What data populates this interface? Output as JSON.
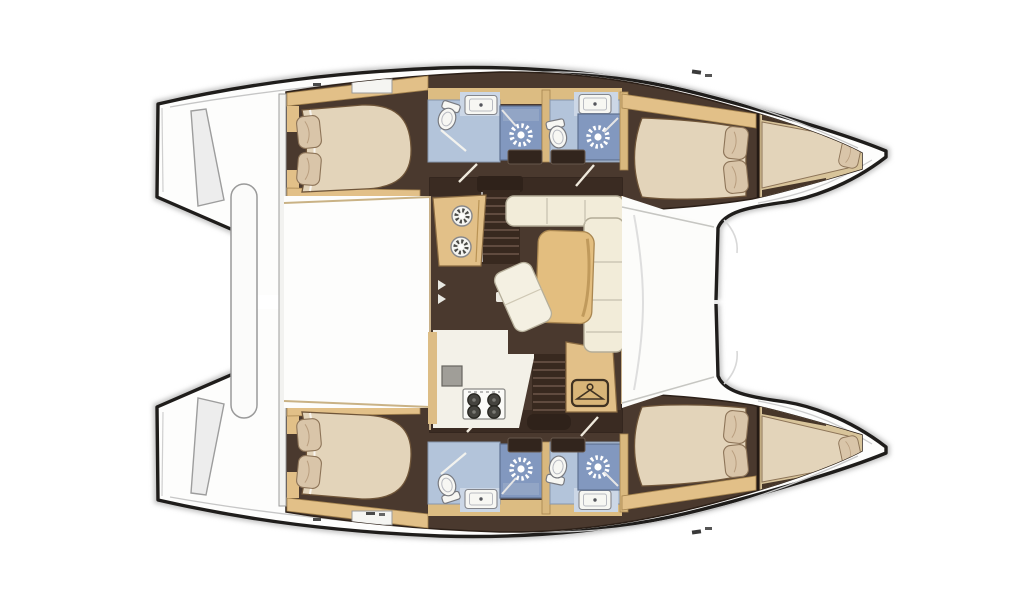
{
  "diagram": {
    "type": "catamaran-floor-plan",
    "orientation": {
      "bow": "right",
      "stern": "left"
    },
    "hulls": [
      "port-hull",
      "starboard-hull"
    ],
    "rooms_per_hull": [
      "aft-cabin-island-bed",
      "aft-head",
      "aft-shower",
      "forward-head",
      "forward-shower",
      "forward-cabin",
      "forepeak-berth"
    ],
    "shared_spaces": [
      "saloon",
      "galley",
      "cockpit-deck",
      "foredeck",
      "trampoline",
      "transom-steps",
      "davit-bar"
    ],
    "icon_counts": {
      "shower-drain-sun": 4,
      "toilet": 4,
      "sink": 4,
      "galley-round-burner": 2,
      "stove-burner": 4,
      "hanger-locker": 1,
      "pillow": 10,
      "double-bed": 4,
      "forepeak-mattress": 2,
      "companionway-stairs": 2
    }
  },
  "colors": {
    "hull_outline": "#1f1d1b",
    "shadow_gray": "#c3c3c3",
    "deck_white": "#fdfdfc",
    "floor_brown": "#4a392e",
    "floor_dark_band": "#3a2b22",
    "wood_tan": "#e2c088",
    "wood_tan_dark": "#8a6b42",
    "wood_light": "#d8c49a",
    "bed_beige": "#e3d4ba",
    "pillow_tan": "#d9c5a9",
    "sofa_cream": "#f2ecd9",
    "table_tan": "#e3be7f",
    "head_blue": "#b3c4da",
    "head_panel_blue": "#ccd7e6",
    "shower_blue": "#8298bf",
    "fixture_white": "#f7f7f3",
    "stair_brown": "#38291f",
    "stair_line": "#6d574a",
    "galley_floor": "#f3f1e8",
    "line_gray": "#b9b9b9"
  }
}
